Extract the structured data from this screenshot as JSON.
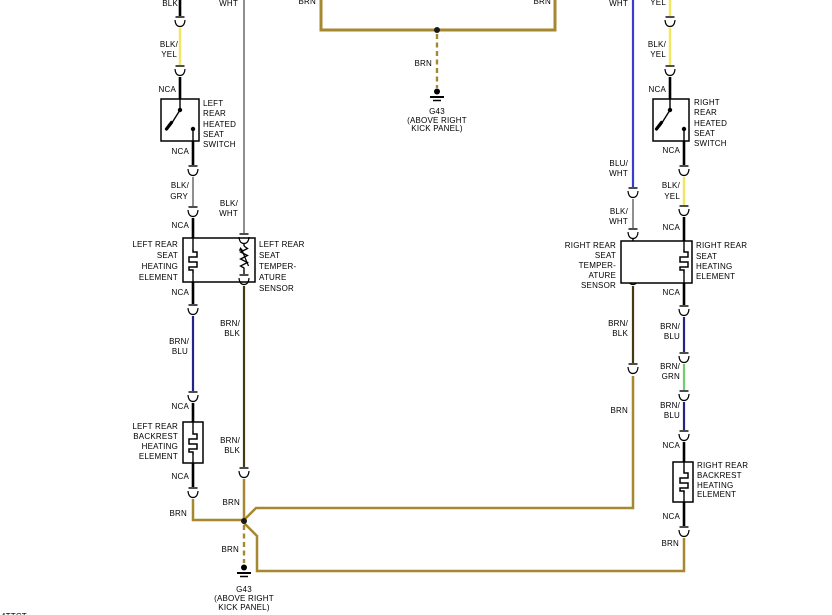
{
  "colors": {
    "brown_wire": "#a5882f",
    "black_wire": "#000000",
    "yellow_wire": "#f0e763",
    "gray_wire": "#8f8f8f",
    "blue_wire": "#3b3bce",
    "dark_blue_wire": "#232388",
    "green_wire": "#6fcf6f",
    "brown_black_wire": "#453a12"
  },
  "top_ground": {
    "wire_left": "BRN",
    "wire_right": "BRN",
    "wire_drop": "BRN",
    "name": "G43",
    "loc1": "(ABOVE RIGHT",
    "loc2": "KICK PANEL)"
  },
  "bottom_ground": {
    "wire_drop": "BRN",
    "name": "G43",
    "loc1": "(ABOVE RIGHT",
    "loc2": "KICK PANEL)"
  },
  "left": {
    "switch": {
      "feed": "BLK",
      "in1": "BLK/",
      "in2": "YEL",
      "nca_in": "NCA",
      "name": [
        "LEFT",
        "REAR",
        "HEATED",
        "SEAT",
        "SWITCH"
      ],
      "nca_out": "NCA",
      "out1": "BLK/",
      "out2": "GRY",
      "nca_box": "NCA"
    },
    "heater": {
      "name": [
        "LEFT REAR",
        "SEAT",
        "HEATING",
        "ELEMENT"
      ],
      "nca_out": "NCA",
      "w1": "BRN/",
      "w2": "BLU",
      "nca_next": "NCA"
    },
    "sensor": {
      "feed": "WHT",
      "in1": "BLK/",
      "in2": "WHT",
      "name": [
        "LEFT REAR",
        "SEAT",
        "TEMPER-",
        "ATURE",
        "SENSOR"
      ],
      "out1a": "BRN/",
      "out1b": "BLK",
      "out2a": "BRN/",
      "out2b": "BLK",
      "out3": "BRN"
    },
    "backrest": {
      "name": [
        "LEFT REAR",
        "BACKREST",
        "HEATING",
        "ELEMENT"
      ],
      "nca_out": "NCA",
      "out": "BRN"
    },
    "junction_drop": "BRN"
  },
  "right": {
    "sensor": {
      "feed": "WHT",
      "in1": "BLU/",
      "in2": "WHT",
      "in3": "BLK/",
      "in4": "WHT",
      "name": [
        "RIGHT REAR",
        "SEAT",
        "TEMPER-",
        "ATURE",
        "SENSOR"
      ],
      "out1a": "BRN/",
      "out1b": "BLK",
      "out2": "BRN"
    },
    "switch": {
      "feed": "YEL",
      "in1": "BLK/",
      "in2": "YEL",
      "nca_in": "NCA",
      "name": [
        "RIGHT",
        "REAR",
        "HEATED",
        "SEAT",
        "SWITCH"
      ],
      "nca_out": "NCA",
      "out1": "BLK/",
      "out2": "YEL",
      "nca_box": "NCA"
    },
    "heater": {
      "name": [
        "RIGHT REAR",
        "SEAT",
        "HEATING",
        "ELEMENT"
      ],
      "nca_out": "NCA",
      "w1a": "BRN/",
      "w1b": "BLU",
      "w2a": "BRN/",
      "w2b": "GRN",
      "w3a": "BRN/",
      "w3b": "BLU",
      "nca_next": "NCA"
    },
    "backrest": {
      "name": [
        "RIGHT REAR",
        "BACKREST",
        "HEATING",
        "ELEMENT"
      ],
      "nca_out": "NCA",
      "out": "BRN"
    }
  },
  "footer": {
    "fragment": "4TTCT"
  }
}
